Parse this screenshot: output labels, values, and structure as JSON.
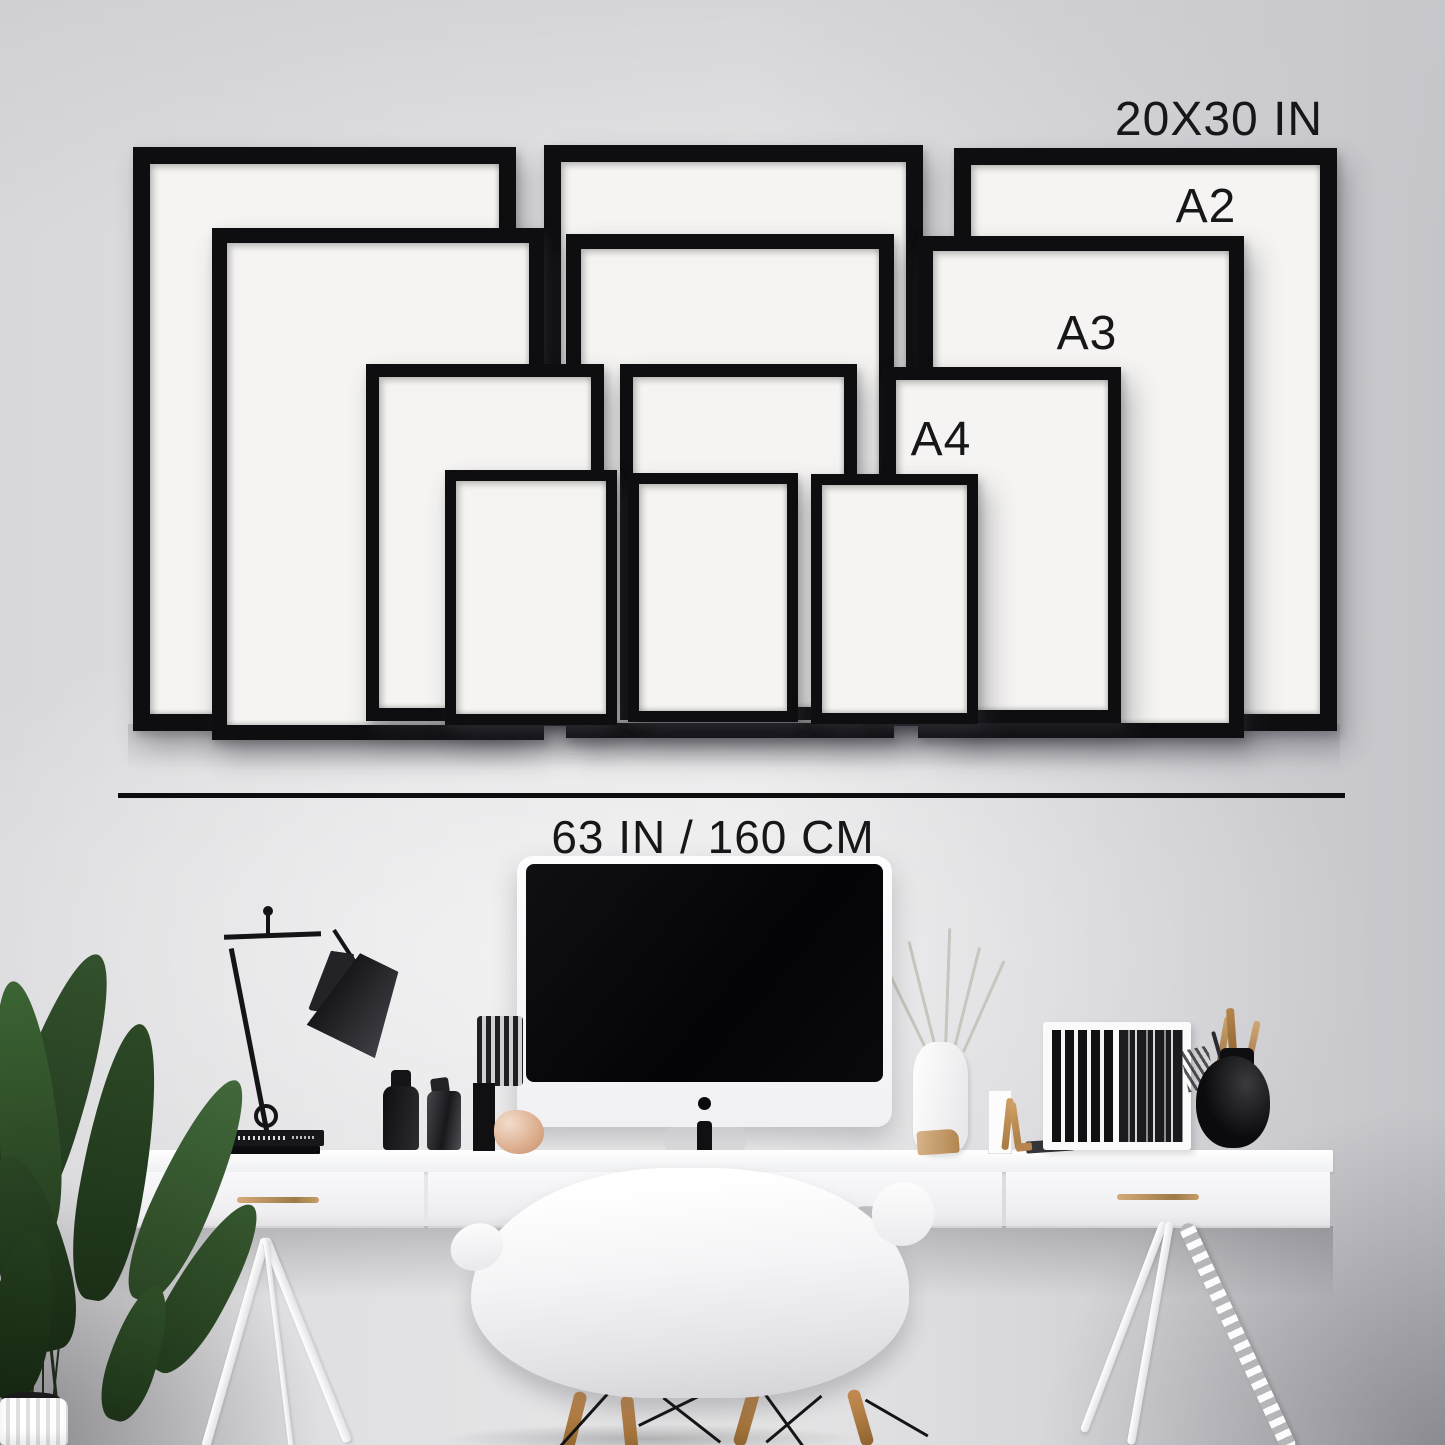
{
  "size_guide": {
    "top_size_label": "20X30 IN",
    "a2_label": "A2",
    "a3_label": "A3",
    "a4_label": "A4",
    "width_measurement_label": "63 IN / 160 CM",
    "frame_sizes": [
      "20X30 IN",
      "A2",
      "A3",
      "A4"
    ],
    "frames_per_size": 3,
    "colors": {
      "frame": "#0e0e10",
      "mat": "#f5f4f2",
      "label_text": "#17171a",
      "measure_line": "#0d0d0f",
      "wall": "#dadadd",
      "brass_handle": "#b98e58"
    }
  }
}
